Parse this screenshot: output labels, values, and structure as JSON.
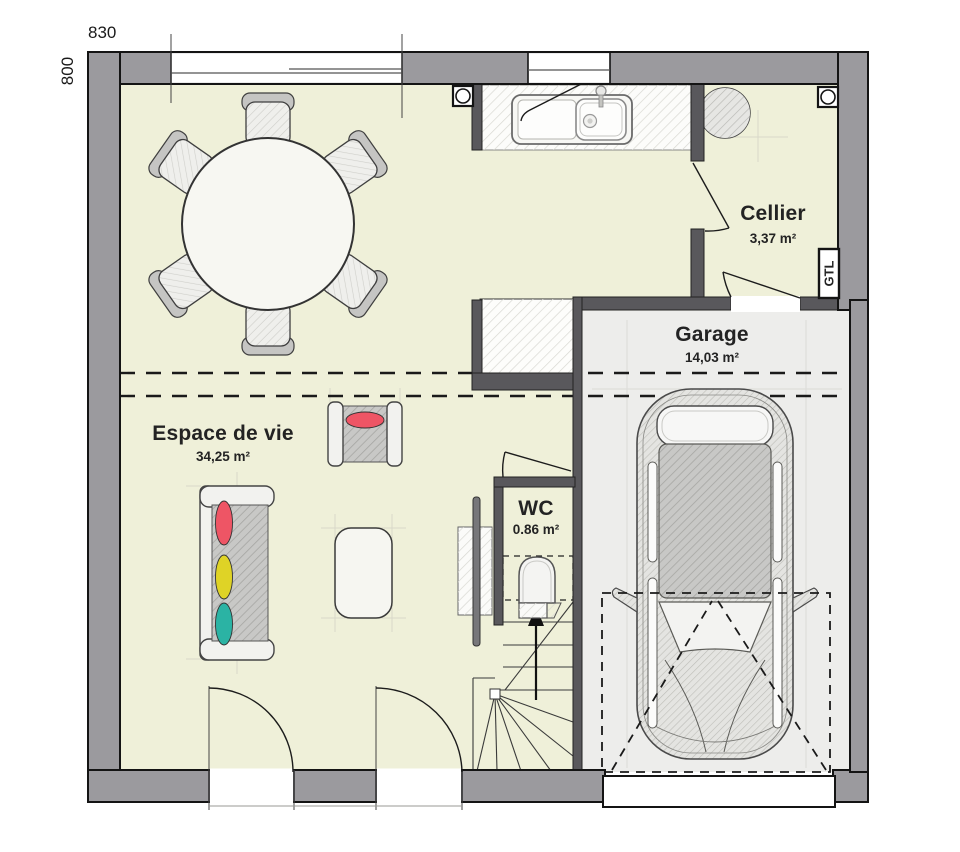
{
  "plan": {
    "type": "floor-plan",
    "dimensions": {
      "top": "830",
      "left": "800"
    },
    "rooms": {
      "living": {
        "name": "Espace de vie",
        "area": "34,25 m²"
      },
      "cellier": {
        "name": "Cellier",
        "area": "3,37 m²"
      },
      "garage": {
        "name": "Garage",
        "area": "14,03 m²"
      },
      "wc": {
        "name": "WC",
        "area": "0.86 m²"
      }
    },
    "labels": {
      "gtl": "GTL"
    },
    "colors": {
      "floor": "#EFF0D9",
      "garage_floor": "#EDEDEB",
      "wall_exterior": "#9B9A9E",
      "wall_interior": "#59585C",
      "outline": "#141414",
      "cushion_red": "#EE5565",
      "cushion_yellow": "#DFD326",
      "cushion_teal": "#2BB3A4"
    }
  }
}
